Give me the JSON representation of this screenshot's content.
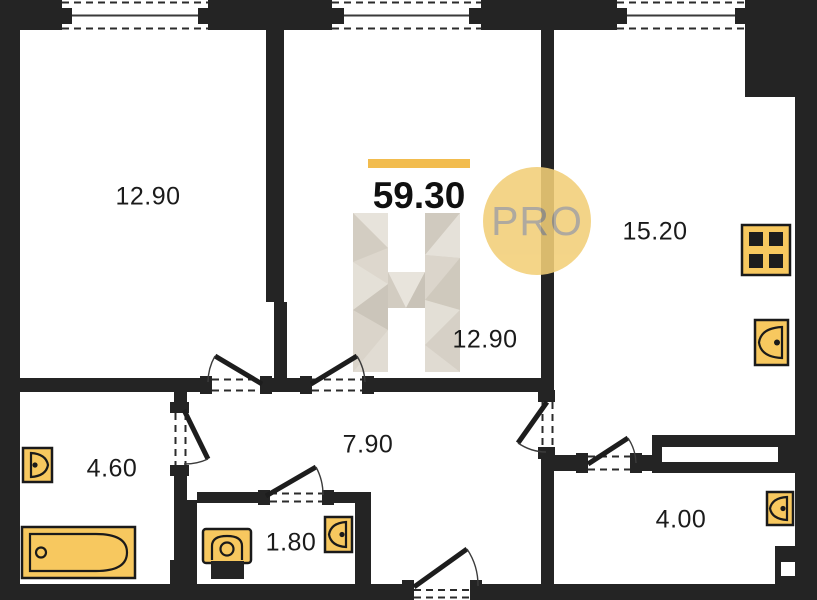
{
  "plan": {
    "total_area_value": "59.30",
    "badge_label": "PRO",
    "rooms": [
      {
        "name": "living-room-1",
        "area": "12.90"
      },
      {
        "name": "living-room-2",
        "area": "12.90"
      },
      {
        "name": "kitchen-living",
        "area": "15.20"
      },
      {
        "name": "bathroom",
        "area": "4.60"
      },
      {
        "name": "hallway",
        "area": "7.90"
      },
      {
        "name": "wc",
        "area": "1.80"
      },
      {
        "name": "storage",
        "area": "4.00"
      }
    ],
    "fixtures": [
      "bathtub",
      "bathroom-sink",
      "toilet",
      "wc-sink",
      "kitchen-stove",
      "kitchen-sink",
      "storage-sink",
      "wardrobe"
    ],
    "colors": {
      "wall": "#242424",
      "fixture": "#F7C85F",
      "accent": "#F2BC4E",
      "badge-bg": "#F2CF78",
      "badge-text": "#A49E92",
      "watermark": "#D8D2C8"
    }
  }
}
